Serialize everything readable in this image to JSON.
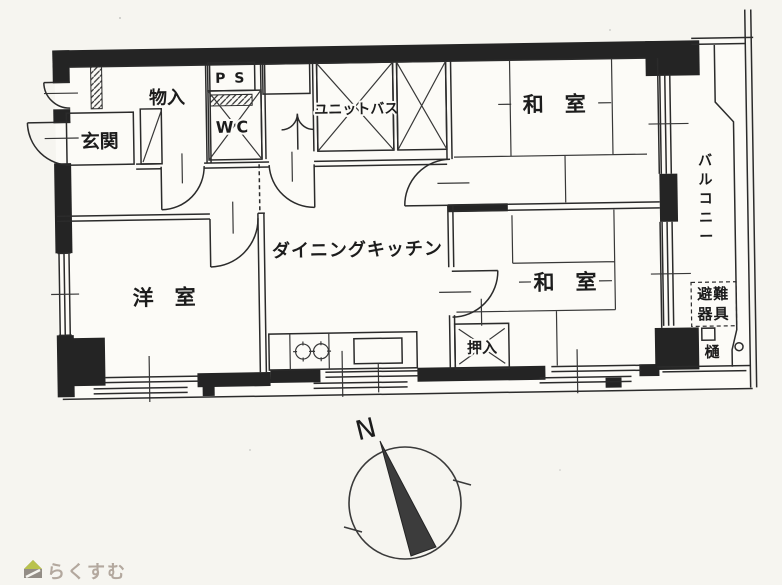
{
  "meta": {
    "kind": "floor-plan",
    "language": "ja"
  },
  "colors": {
    "ink": "#2b2b2b",
    "paper": "#f6f5f0",
    "floor": "#fcfbf7",
    "needle": "#3c3c3c",
    "watermark_text": "#b3a89e",
    "watermark_roof_green": "#b9c24e",
    "watermark_body_gray": "#938d86"
  },
  "plan": {
    "rooms": {
      "entrance": {
        "label": "玄関"
      },
      "storage": {
        "label": "物入"
      },
      "pipe_space": {
        "label": "P S"
      },
      "toilet": {
        "label": "WC"
      },
      "unit_bath": {
        "label": "ユニットバス"
      },
      "dining_kitchen": {
        "label": "ダイニングキッチン"
      },
      "western_room": {
        "label": "洋　室"
      },
      "japanese_room_top": {
        "label": "和　室"
      },
      "japanese_room_bottom": {
        "label": "和　室"
      },
      "closet": {
        "label": "押入"
      },
      "balcony": {
        "label": "バルコニー"
      }
    },
    "annotations": {
      "evacuation_line1": "避難",
      "evacuation_line2": "器具",
      "gutter": "樋"
    }
  },
  "compass": {
    "north_label": "N"
  },
  "watermark": {
    "text": "らくすむ"
  }
}
